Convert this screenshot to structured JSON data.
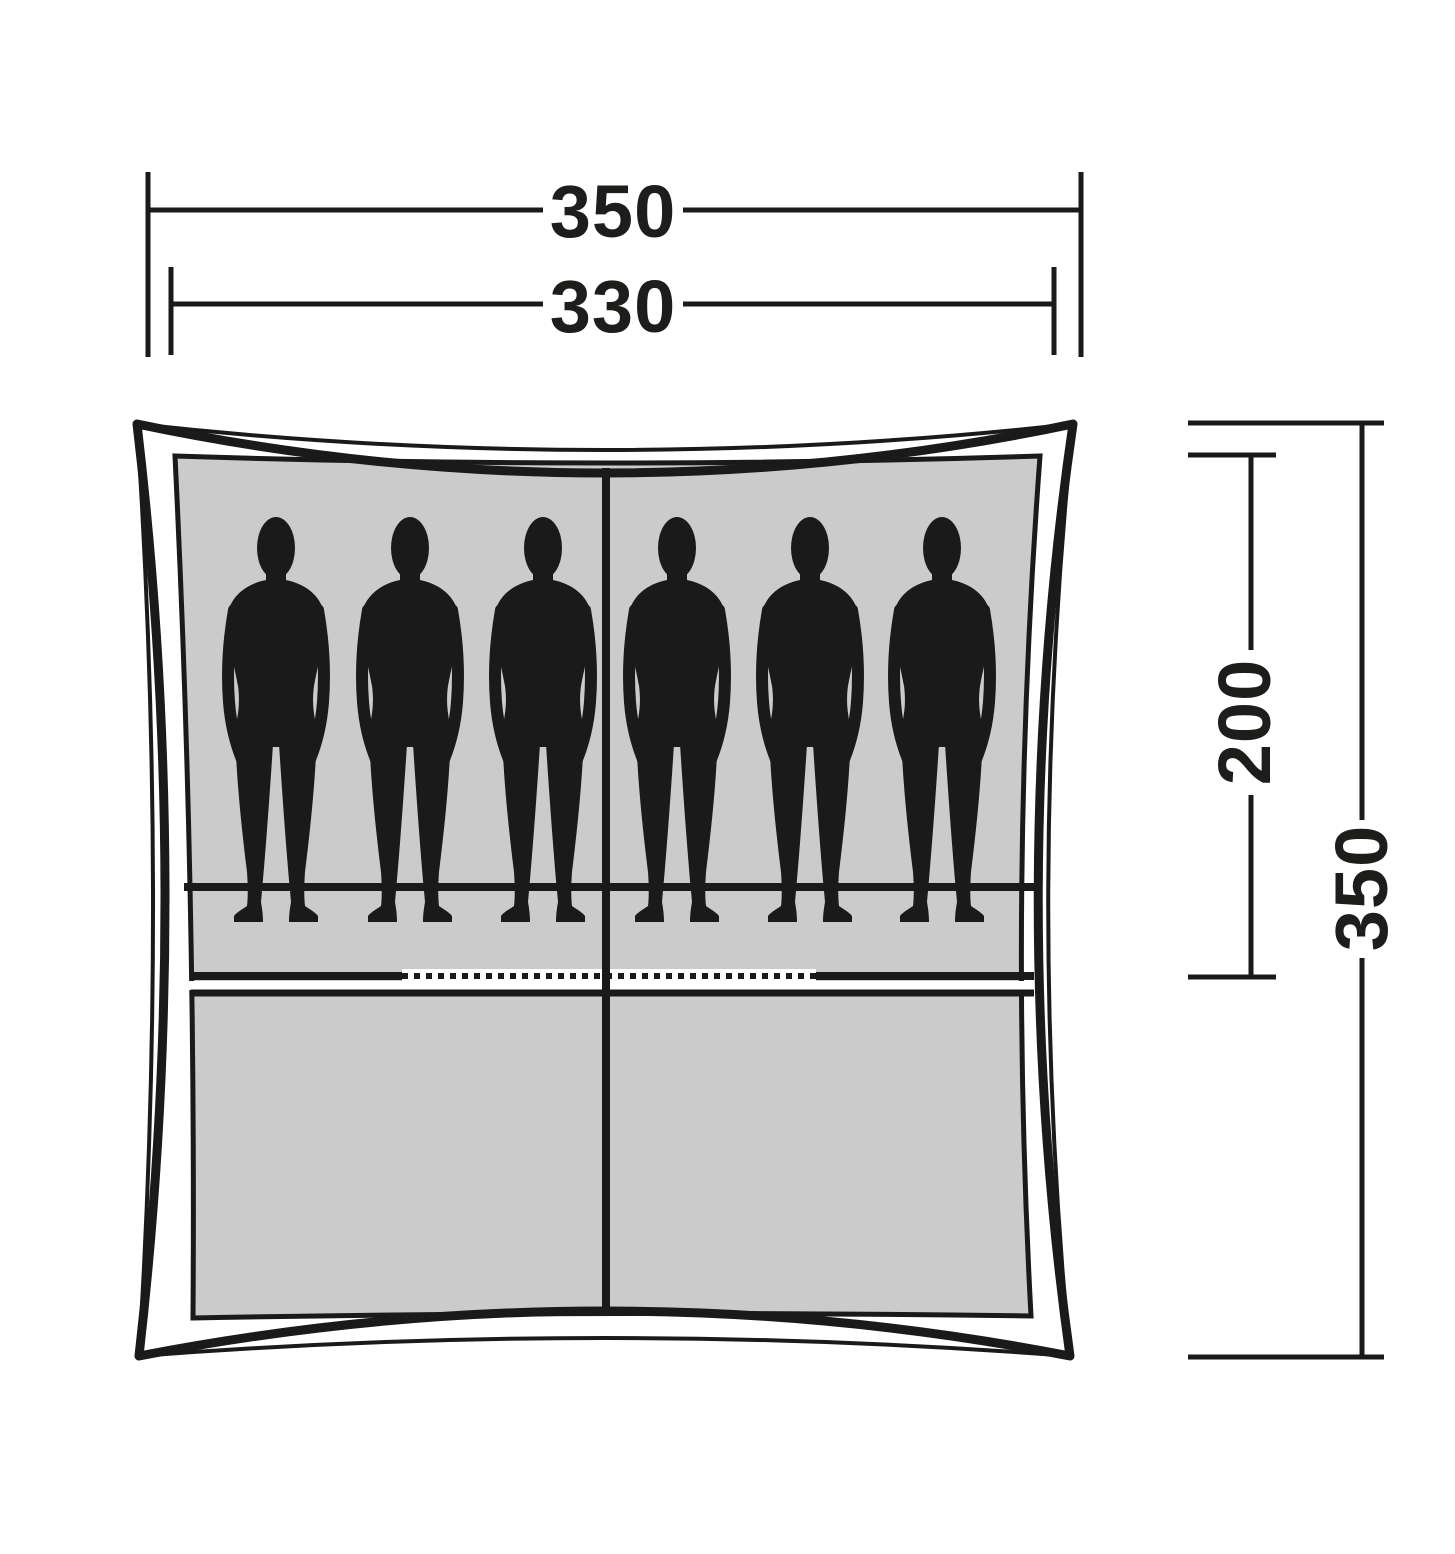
{
  "diagram": {
    "kind": "tent-top-view-floorplan",
    "dimension_labels": {
      "total_width": "350",
      "inner_width": "330",
      "inner_depth": "200",
      "total_depth": "350"
    },
    "occupancy": {
      "person_silhouette_count": 6
    },
    "colors": {
      "outline_and_lines": "#1a1a1a",
      "label_text": "#1d1d1b",
      "groundsheet_fill": "#cbcbcb",
      "silhouette_fill": "#1a1a1a",
      "background": "#ffffff"
    }
  }
}
